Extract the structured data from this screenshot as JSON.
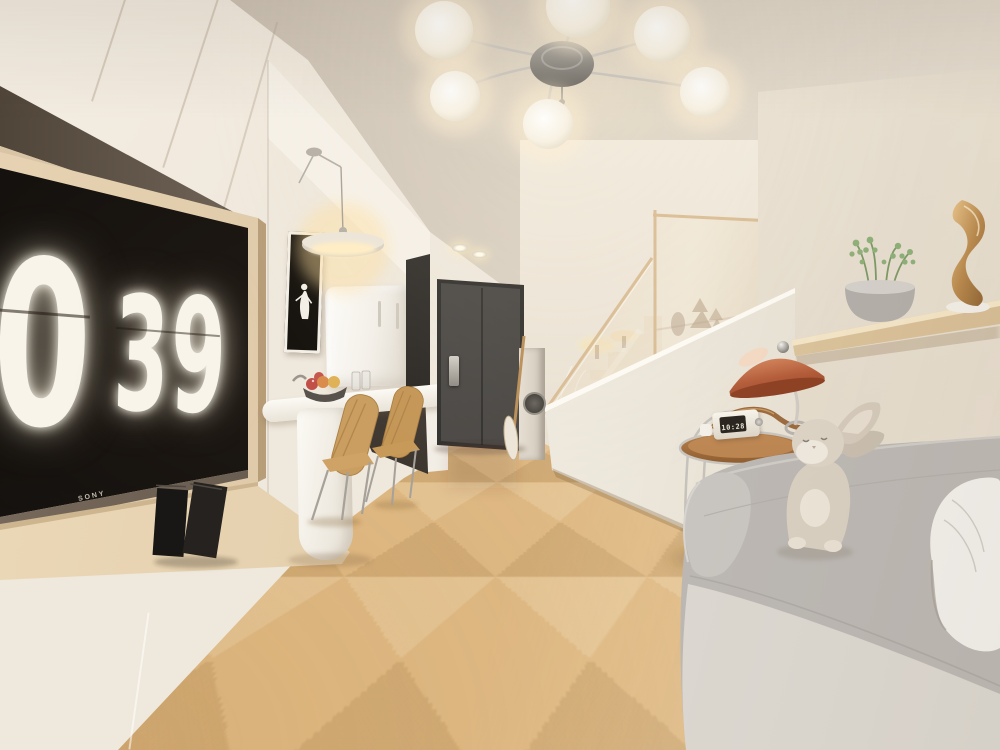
{
  "scene": {
    "type": "photorealistic interior render",
    "room": "open-plan duplex apartment: living wall with flip-clock TV, kitchenette with breakfast bar, entry hallway with dark door, staircase with glass balustrade, loft shelf and gray sofa",
    "lighting": "warm globe chandelier and pendant lamp"
  },
  "tv": {
    "brand": "SONY",
    "display": "flip clock",
    "clock_hour": "0",
    "clock_minutes": "39"
  },
  "side_table_clock": {
    "time": "10:28"
  },
  "palette": {
    "ceiling": "#d3c8bb",
    "wall_cream": "#efe8dd",
    "floor_oak": "#e0bb86",
    "door_gray": "#4b4947",
    "sofa_gray": "#c8c5c0",
    "terracotta": "#b45c3a",
    "wood_light": "#ddc8a6",
    "gold": "#c09055",
    "plant_green": "#8fb079",
    "screen_black": "#14100d",
    "digit_white": "#f8f4ea",
    "glass_tint": "#dfc3a0"
  },
  "objects": [
    "globe chandelier",
    "wall TV showing flip clock",
    "leaning black slabs on console",
    "pendant disc lamp",
    "framed monochrome artwork",
    "white fridge",
    "breakfast bar with fruit bowl and glasses",
    "two wooden chairs with chrome legs",
    "dark entry door with smart lock",
    "recessed ceiling spotlights",
    "leaning wooden oar",
    "washer niche",
    "staircase with wood-framed glass balustrade",
    "floating wood shelf with succulent pot and gold sculpture",
    "terracotta desk lamp",
    "wooden bar cart with small flip clock",
    "plush bunny",
    "gray sofa with white round pillow",
    "chevron parquet floor"
  ]
}
